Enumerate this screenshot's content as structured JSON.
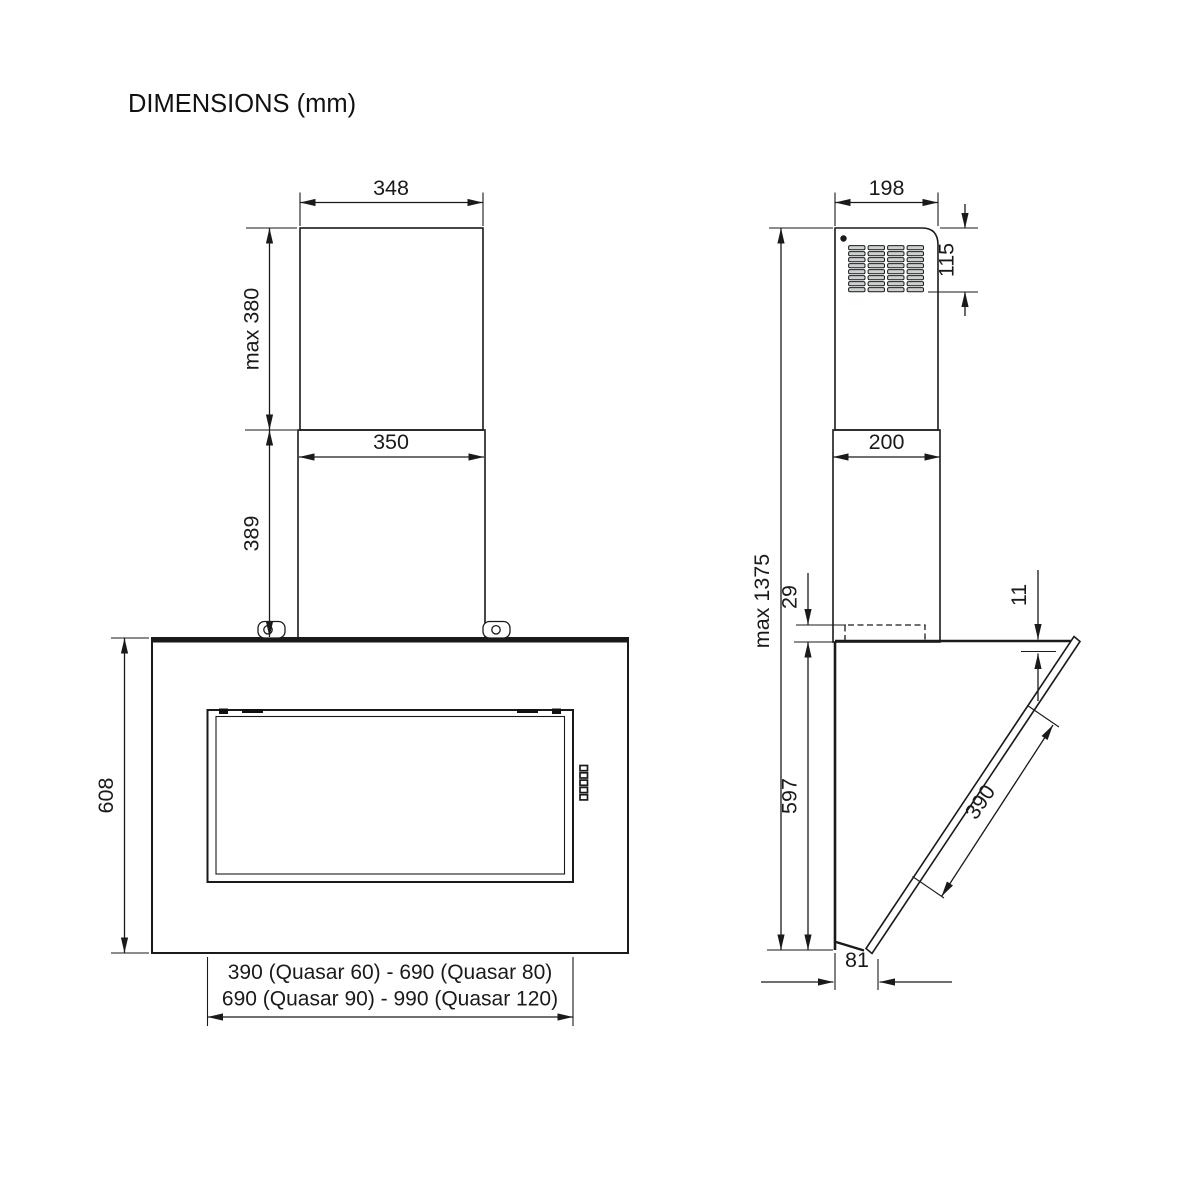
{
  "title": "DIMENSIONS (mm)",
  "colors": {
    "line": "#1a1a1a",
    "duct_fill": "#d4d5d5",
    "grille_slat_fill": "#cdd0d0",
    "background": "#ffffff"
  },
  "front_view": {
    "duct_top_width": "348",
    "duct_upper_height": "max 380",
    "duct_bottom_width": "350",
    "duct_lower_height": "389",
    "body_height": "608",
    "width_models_line1": "390 (Quasar 60) - 690 (Quasar 80)",
    "width_models_line2": "690 (Quasar 90) - 990 (Quasar 120)"
  },
  "side_view": {
    "duct_top_depth": "198",
    "vent_height": "115",
    "duct_bottom_depth": "200",
    "max_total_height": "max 1375",
    "chimney_overlap": "29",
    "back_height": "597",
    "glass_top_offset": "11",
    "glass_length": "390",
    "bottom_depth": "81"
  }
}
